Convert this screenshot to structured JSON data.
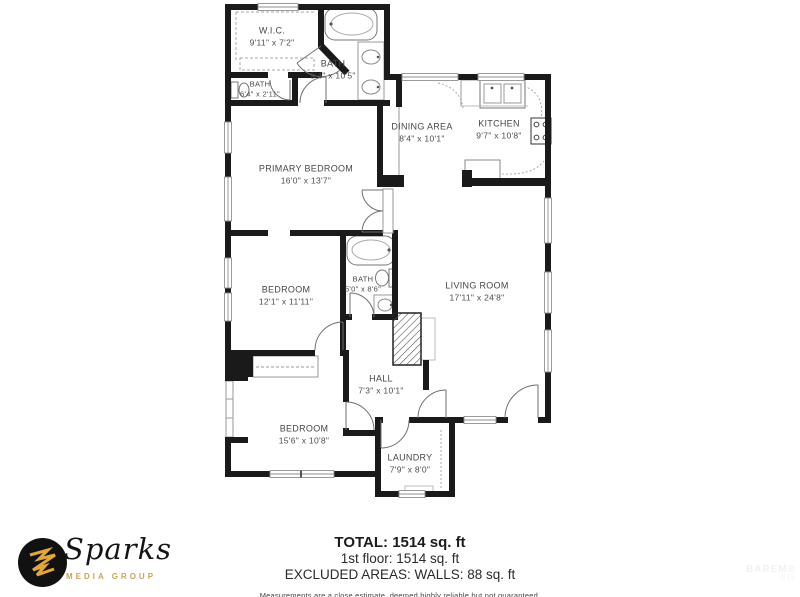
{
  "plan": {
    "rooms": [
      {
        "id": "wic",
        "name": "W.I.C.",
        "dims": "9'11\" x 7'2\""
      },
      {
        "id": "bath-main",
        "name": "BATH",
        "dims": "9'4\" x 10'5\""
      },
      {
        "id": "bath-small",
        "name": "BATH",
        "dims": "6'4\" x 2'11\""
      },
      {
        "id": "dining-area",
        "name": "DINING AREA",
        "dims": "8'4\" x 10'1\""
      },
      {
        "id": "kitchen",
        "name": "KITCHEN",
        "dims": "9'7\" x 10'8\""
      },
      {
        "id": "primary-bedroom",
        "name": "PRIMARY BEDROOM",
        "dims": "16'0\" x 13'7\""
      },
      {
        "id": "bedroom-middle",
        "name": "BEDROOM",
        "dims": "12'1\" x 11'11\""
      },
      {
        "id": "bath-hall",
        "name": "BATH",
        "dims": "5'0\" x 8'6\""
      },
      {
        "id": "living-room",
        "name": "LIVING ROOM",
        "dims": "17'11\" x 24'8\""
      },
      {
        "id": "hall",
        "name": "HALL",
        "dims": "7'3\" x 10'1\""
      },
      {
        "id": "bedroom-rear",
        "name": "BEDROOM",
        "dims": "15'6\" x 10'8\""
      },
      {
        "id": "laundry",
        "name": "LAUNDRY",
        "dims": "7'9\" x 8'0\""
      }
    ]
  },
  "summary": {
    "total": "TOTAL: 1514 sq. ft",
    "floor": "1st floor: 1514 sq. ft",
    "excluded": "EXCLUDED AREAS: WALLS: 88 sq. ft",
    "disclaimer": "Measurements are a close estimate, deemed highly reliable but not guaranteed."
  },
  "branding": {
    "logo_name": "Sparks",
    "logo_subtitle": "MEDIA GROUP",
    "colors": {
      "logo_gold": "#e3a63b",
      "subtitle_gold": "#cfa453",
      "wall": "#1a1a1a"
    }
  },
  "watermark": {
    "line1": "BAREM®",
    "line2": "NTS"
  }
}
